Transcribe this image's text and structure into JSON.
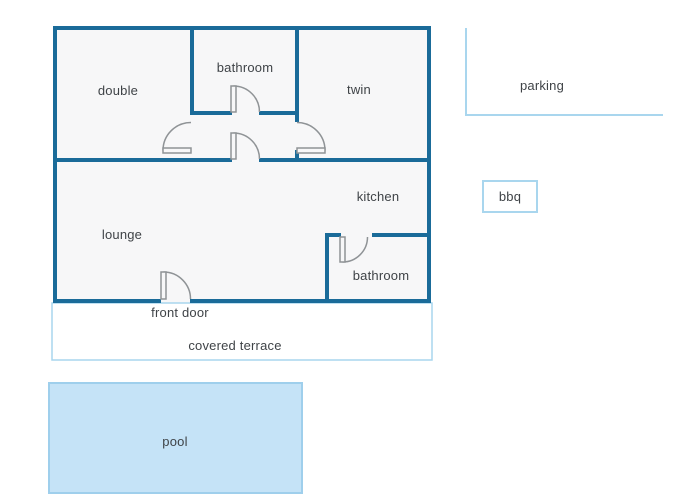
{
  "colors": {
    "wall": "#1a6b99",
    "room_fill": "#f7f7f8",
    "accent_light": "#a9d6ee",
    "pool_fill": "#c5e3f7",
    "pool_border": "#9fcfec",
    "door_stroke": "#8f9396",
    "label_text": "#3f4347"
  },
  "rooms": {
    "double": "double",
    "bathroom_top": "bathroom",
    "twin": "twin",
    "kitchen": "kitchen",
    "lounge": "lounge",
    "bathroom_bottom": "bathroom"
  },
  "outdoor": {
    "front_door": "front door",
    "covered_terrace": "covered terrace",
    "pool": "pool",
    "parking": "parking",
    "bbq": "bbq"
  }
}
